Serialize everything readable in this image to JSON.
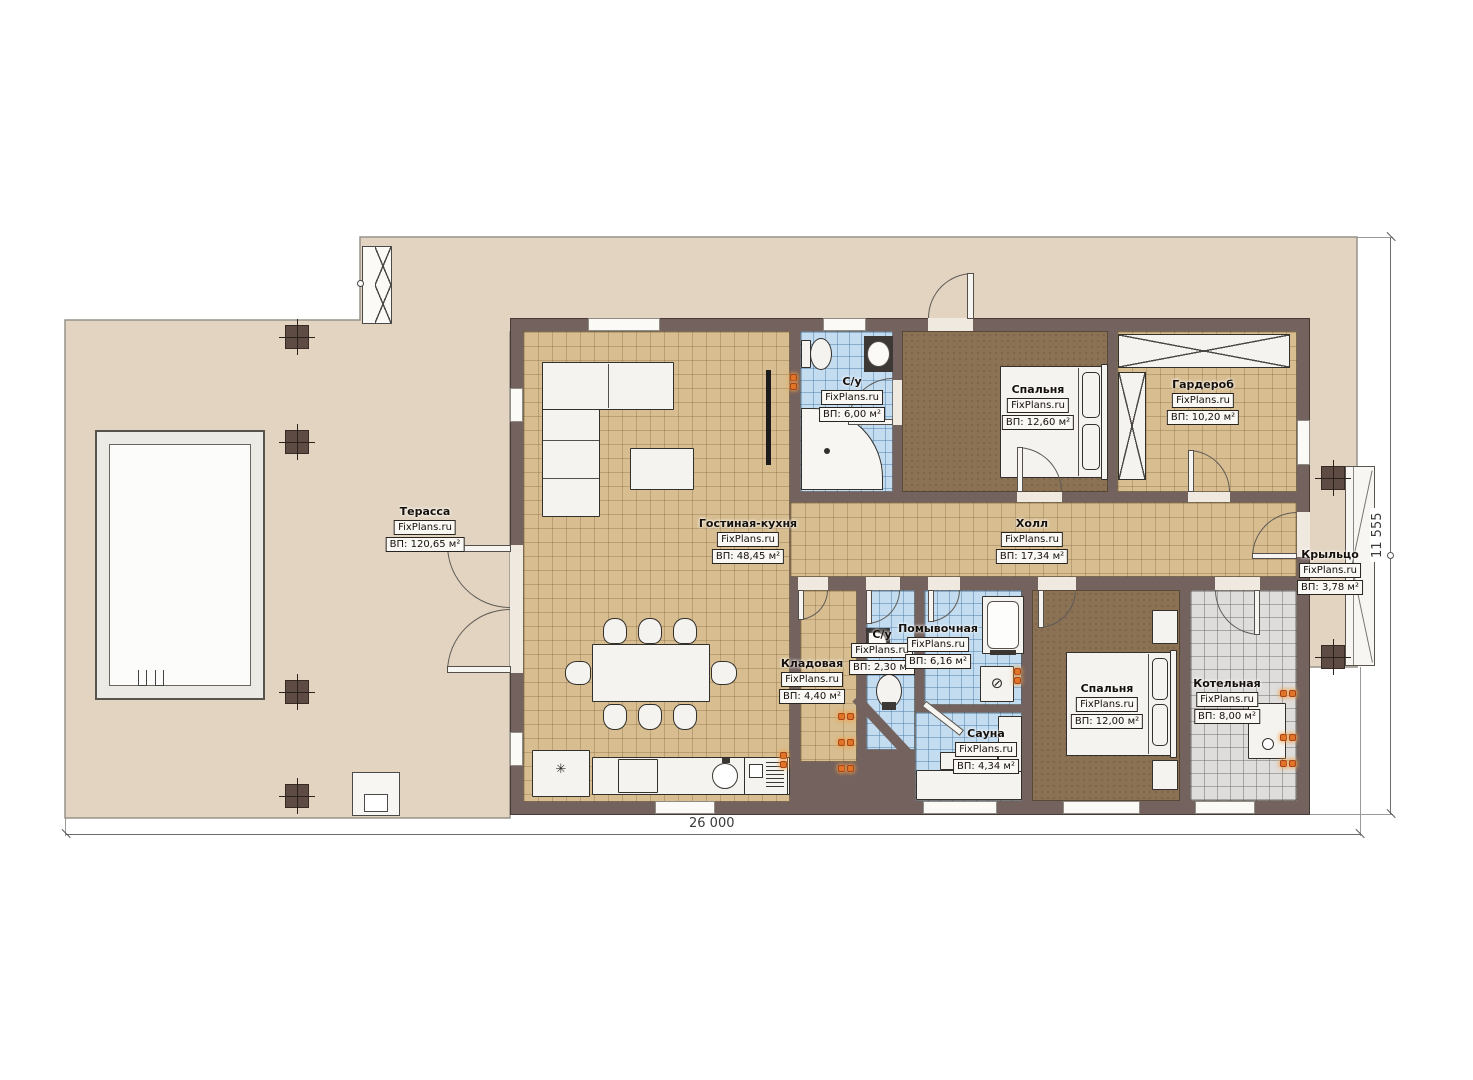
{
  "meta": {
    "type": "floor-plan",
    "language": "ru"
  },
  "brand": "FixPlans.ru",
  "dimensions": {
    "width_label": "26 000",
    "height_label": "11 555"
  },
  "rooms": {
    "terrace": {
      "name": "Терасса",
      "area": "ВП: 120,65 м²"
    },
    "living_kitchen": {
      "name": "Гостиная-кухня",
      "area": "ВП: 48,45 м²"
    },
    "wc_top": {
      "name": "С/у",
      "area": "ВП: 6,00 м²"
    },
    "bedroom_top": {
      "name": "Спальня",
      "area": "ВП: 12,60 м²"
    },
    "wardrobe": {
      "name": "Гардероб",
      "area": "ВП: 10,20 м²"
    },
    "hall": {
      "name": "Холл",
      "area": "ВП: 17,34 м²"
    },
    "porch": {
      "name": "Крыльцо",
      "area": "ВП: 3,78 м²"
    },
    "storage": {
      "name": "Кладовая",
      "area": "ВП: 4,40 м²"
    },
    "wc_bottom": {
      "name": "С/у",
      "area": "ВП: 2,30 м²"
    },
    "washroom": {
      "name": "Помывочная",
      "area": "ВП: 6,16 м²"
    },
    "sauna": {
      "name": "Сауна",
      "area": "ВП: 4,34 м²"
    },
    "bedroom_bottom": {
      "name": "Спальня",
      "area": "ВП: 12,00 м²"
    },
    "boiler": {
      "name": "Котельная",
      "area": "ВП: 8,00 м²"
    }
  },
  "icons": {
    "snowflake": "✳",
    "stove": "⊘"
  },
  "colors": {
    "terrace": "#e2d4c0",
    "wall": "#74625f",
    "tile_tan": "#d7bd90",
    "tile_blue": "#c3dcef",
    "carpet": "#8b7254",
    "tile_gray": "#dedddb",
    "radiator": "#e07427",
    "page": "#ffffff"
  }
}
